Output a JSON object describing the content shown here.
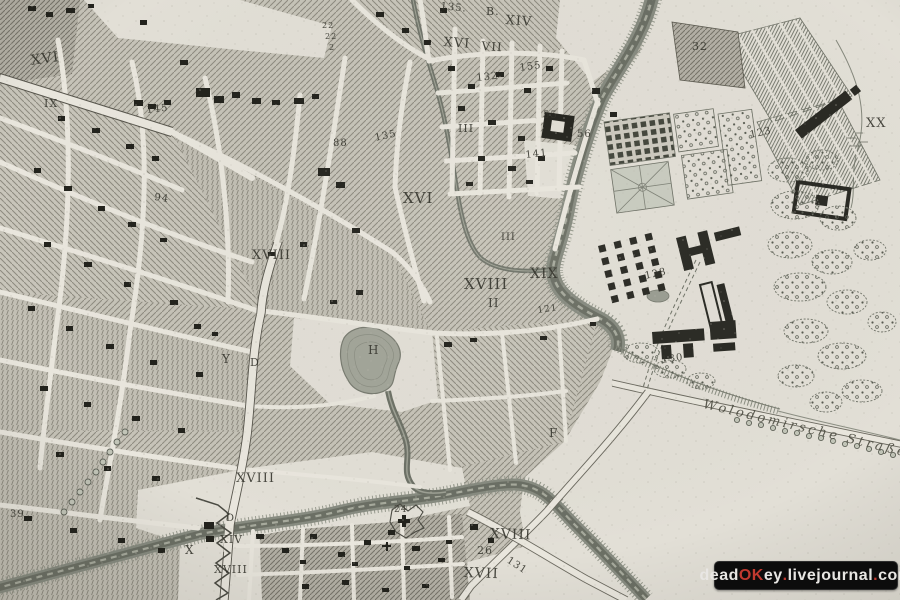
{
  "map": {
    "description": "antique engraved city map scan",
    "street_label": {
      "text": "Wolodomirsche Straße",
      "x": 705,
      "y": 398,
      "size": 13,
      "rotate": 13.5
    },
    "labels": [
      {
        "t": "XVI",
        "x": 30,
        "y": 54,
        "s": 14,
        "r": -8
      },
      {
        "t": "IX",
        "x": 44,
        "y": 98,
        "s": 11,
        "r": 0
      },
      {
        "t": "145",
        "x": 146,
        "y": 106,
        "s": 10,
        "r": -6
      },
      {
        "t": "94",
        "x": 155,
        "y": 193,
        "s": 10,
        "r": 8
      },
      {
        "t": "22",
        "x": 322,
        "y": 22,
        "s": 8,
        "r": 0
      },
      {
        "t": "22",
        "x": 325,
        "y": 33,
        "s": 8,
        "r": 0
      },
      {
        "t": "2",
        "x": 329,
        "y": 44,
        "s": 8,
        "r": 0
      },
      {
        "t": "88",
        "x": 333,
        "y": 139,
        "s": 10,
        "r": 0
      },
      {
        "t": "135",
        "x": 374,
        "y": 134,
        "s": 10,
        "r": -12
      },
      {
        "t": "135.",
        "x": 441,
        "y": 2,
        "s": 10,
        "r": 6
      },
      {
        "t": "B.",
        "x": 486,
        "y": 6,
        "s": 11,
        "r": 0
      },
      {
        "t": "XIV",
        "x": 506,
        "y": 14,
        "s": 13,
        "r": 4
      },
      {
        "t": "XVI",
        "x": 444,
        "y": 36,
        "s": 13,
        "r": 4
      },
      {
        "t": "VII",
        "x": 482,
        "y": 40,
        "s": 12,
        "r": 4
      },
      {
        "t": "132",
        "x": 476,
        "y": 74,
        "s": 10,
        "r": -6
      },
      {
        "t": "155",
        "x": 519,
        "y": 64,
        "s": 10,
        "r": -8
      },
      {
        "t": "III",
        "x": 458,
        "y": 123,
        "s": 11,
        "r": 0
      },
      {
        "t": "55",
        "x": 543,
        "y": 111,
        "s": 10,
        "r": 0
      },
      {
        "t": "56",
        "x": 577,
        "y": 130,
        "s": 10,
        "r": 0
      },
      {
        "t": "141",
        "x": 525,
        "y": 151,
        "s": 10,
        "r": -6
      },
      {
        "t": "XVI",
        "x": 403,
        "y": 191,
        "s": 15,
        "r": 0
      },
      {
        "t": "XVIII",
        "x": 252,
        "y": 249,
        "s": 13,
        "r": 0
      },
      {
        "t": "III",
        "x": 501,
        "y": 233,
        "s": 10,
        "r": 0
      },
      {
        "t": "XVIII",
        "x": 464,
        "y": 277,
        "s": 15,
        "r": 0
      },
      {
        "t": "XIX",
        "x": 530,
        "y": 267,
        "s": 14,
        "r": 0
      },
      {
        "t": "II",
        "x": 488,
        "y": 297,
        "s": 12,
        "r": 0
      },
      {
        "t": "121",
        "x": 537,
        "y": 307,
        "s": 9,
        "r": -8
      },
      {
        "t": "32",
        "x": 692,
        "y": 41,
        "s": 11,
        "r": 0
      },
      {
        "t": "123",
        "x": 749,
        "y": 131,
        "s": 10,
        "r": -12
      },
      {
        "t": "XX",
        "x": 866,
        "y": 117,
        "s": 13,
        "r": 0
      },
      {
        "t": "128",
        "x": 644,
        "y": 272,
        "s": 10,
        "r": -12
      },
      {
        "t": "130",
        "x": 661,
        "y": 356,
        "s": 10,
        "r": -8
      },
      {
        "t": "Y",
        "x": 222,
        "y": 353,
        "s": 12,
        "r": 0
      },
      {
        "t": "D",
        "x": 250,
        "y": 357,
        "s": 11,
        "r": 0
      },
      {
        "t": "H",
        "x": 368,
        "y": 344,
        "s": 12,
        "r": 0
      },
      {
        "t": "F",
        "x": 549,
        "y": 427,
        "s": 12,
        "r": 0
      },
      {
        "t": "XVIII",
        "x": 236,
        "y": 472,
        "s": 13,
        "r": 0
      },
      {
        "t": "D",
        "x": 226,
        "y": 514,
        "s": 10,
        "r": 0
      },
      {
        "t": "XIV",
        "x": 220,
        "y": 534,
        "s": 11,
        "r": 0
      },
      {
        "t": "X",
        "x": 185,
        "y": 544,
        "s": 12,
        "r": 0
      },
      {
        "t": "XVIII",
        "x": 214,
        "y": 564,
        "s": 11,
        "r": 0
      },
      {
        "t": "39",
        "x": 10,
        "y": 510,
        "s": 10,
        "r": 0
      },
      {
        "t": "24",
        "x": 394,
        "y": 506,
        "s": 9,
        "r": 0
      },
      {
        "t": "XVIII",
        "x": 490,
        "y": 527,
        "s": 14,
        "r": 2
      },
      {
        "t": "26",
        "x": 477,
        "y": 545,
        "s": 11,
        "r": 0
      },
      {
        "t": "131",
        "x": 510,
        "y": 556,
        "s": 10,
        "r": 33
      },
      {
        "t": "XVII",
        "x": 464,
        "y": 566,
        "s": 14,
        "r": 2
      }
    ]
  },
  "watermark": {
    "x": 714,
    "y": 561,
    "w": 182,
    "h": 27,
    "segments": [
      {
        "t": "dead",
        "c": "#e8e6e3"
      },
      {
        "t": "OK",
        "c": "#c0392f"
      },
      {
        "t": "ey",
        "c": "#e8e6e3"
      },
      {
        "t": ".",
        "c": "#c0392f"
      },
      {
        "t": "livejournal",
        "c": "#e8e6e3"
      },
      {
        "t": ".",
        "c": "#c0392f"
      },
      {
        "t": "com",
        "c": "#e8e6e3"
      }
    ]
  },
  "colors": {
    "paper": "#e2dfd6",
    "ink": "#33332b",
    "water": "#6b6f64",
    "accent_red": "#c0392f",
    "watermark_bg": "#0c0c0c"
  }
}
